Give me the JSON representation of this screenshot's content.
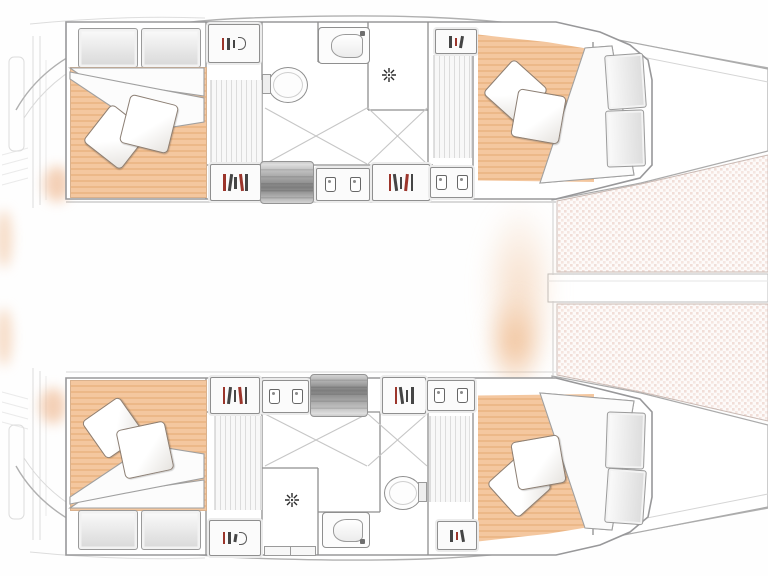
{
  "floorplan": {
    "vessel_label": "catamaran lower-deck floor plan, bow to the right",
    "legend": {
      "hull_top": "port hull",
      "hull_bottom": "starboard hull",
      "aft_cabin": "aft double cabin",
      "fwd_cabin": "forward double cabin",
      "head": "head with shower, sink and toilet",
      "stairs": "companionway steps",
      "wardrobe": "hanging locker",
      "shelves": "stowage shelves",
      "corridor": "hull corridor floorboards",
      "trampoline": "bow trampoline",
      "walkway": "bow center walkway",
      "stern": "transom steps"
    }
  },
  "colors": {
    "mattress": "#f4c79f",
    "mattress_stripe": "#ecb888",
    "pillow_border": "#8c7f74",
    "symbol_red": "#9c352b",
    "symbol_dark": "#454545",
    "floor_stripe": "#dcdcdc",
    "hull_outline": "#98989a",
    "wall": "#8f8f8f",
    "sketch": "#c2c2c2",
    "tramp_a": "#f1ded8",
    "tramp_b": "#f5e6e1",
    "glow": "#f0bd92"
  }
}
